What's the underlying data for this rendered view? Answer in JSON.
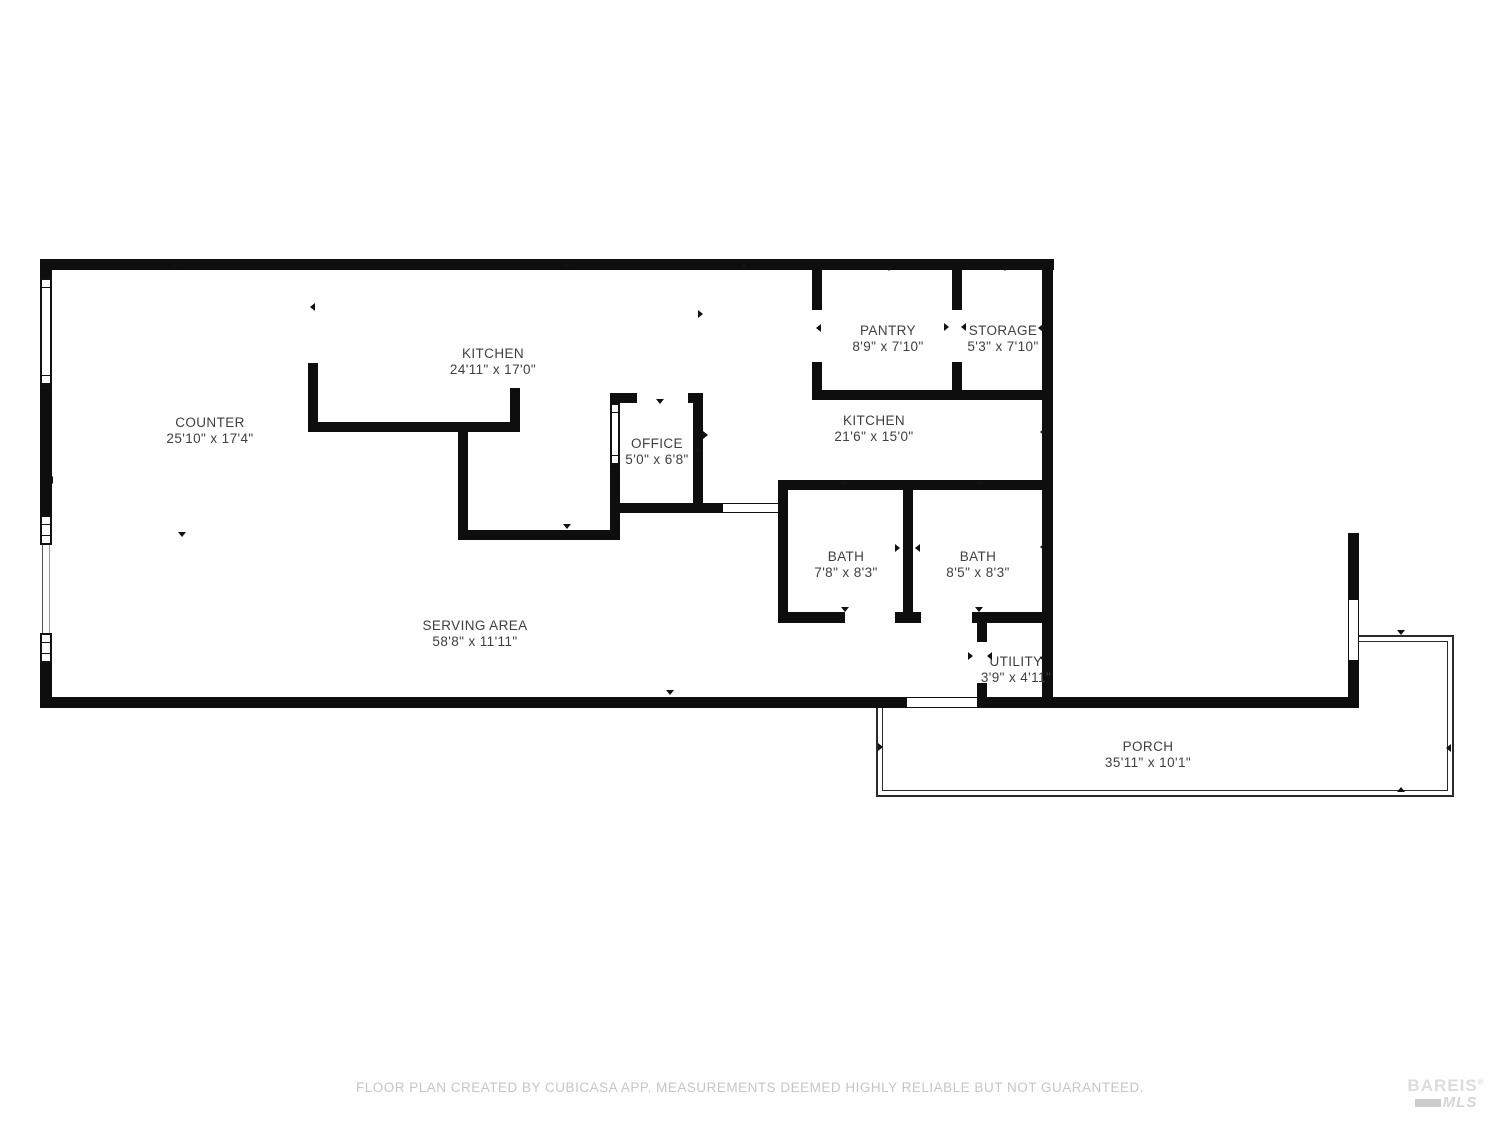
{
  "colors": {
    "wall": "#0e0e0e",
    "room_label": "#3f3f3f",
    "disclaimer_text": "#c6c6c6",
    "logo": "#d6d6d6"
  },
  "rooms": {
    "counter": {
      "name": "COUNTER",
      "dims": "25'10\" x 17'4\""
    },
    "kitchen_island": {
      "name": "KITCHEN",
      "dims": "24'11\" x 17'0\""
    },
    "pantry": {
      "name": "PANTRY",
      "dims": "8'9\" x 7'10\""
    },
    "storage": {
      "name": "STORAGE",
      "dims": "5'3\" x 7'10\""
    },
    "kitchen": {
      "name": "KITCHEN",
      "dims": "21'6\" x 15'0\""
    },
    "office": {
      "name": "OFFICE",
      "dims": "5'0\" x 6'8\""
    },
    "bath_left": {
      "name": "BATH",
      "dims": "7'8\" x 8'3\""
    },
    "bath_right": {
      "name": "BATH",
      "dims": "8'5\" x 8'3\""
    },
    "serving_area": {
      "name": "SERVING AREA",
      "dims": "58'8\" x 11'11\""
    },
    "utility": {
      "name": "UTILITY",
      "dims": "3'9\" x 4'11\""
    },
    "porch": {
      "name": "PORCH",
      "dims": "35'11\" x 10'1\""
    }
  },
  "footer": {
    "disclaimer": "FLOOR PLAN CREATED BY CUBICASA APP. MEASUREMENTS DEEMED HIGHLY RELIABLE BUT NOT GUARANTEED.",
    "logo": {
      "line1": "BAREIS",
      "registered": "®",
      "line2": "MLS"
    }
  }
}
